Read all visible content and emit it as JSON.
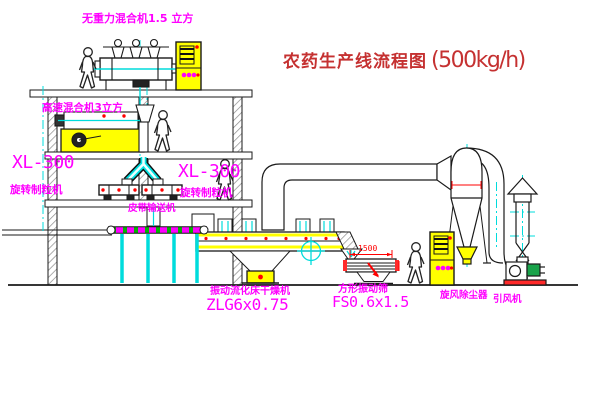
{
  "title": {
    "text": "农药生产线流程图",
    "capacity": "(500kg/h)"
  },
  "labels": {
    "top_mixer": "无重力混合机1.5 立方",
    "mid_mixer": "高速混合机3立方",
    "granulator_left_model": "XL-300",
    "granulator_left_name": "旋转制粒机",
    "granulator_right_model": "XL-300",
    "granulator_right_name": "旋转制粒机",
    "belt_conveyor": "皮带输送机",
    "dryer_name": "振动流化床干燥机",
    "dryer_model": "ZLG6x0.75",
    "screen_name": "方形振动筛",
    "screen_model": "FS0.6x1.5",
    "screen_dimension": "1500",
    "cyclone": "旋风除尘器",
    "fan": "引风机"
  },
  "colors": {
    "label_magenta": "#ff00ff",
    "title_red": "#c53131",
    "equipment_yellow": "#ffff00",
    "centerline_cyan": "#00dcdc",
    "accent_red": "#ff0000",
    "conveyor_green": "#00b400",
    "line_black": "#1a1a1a"
  }
}
